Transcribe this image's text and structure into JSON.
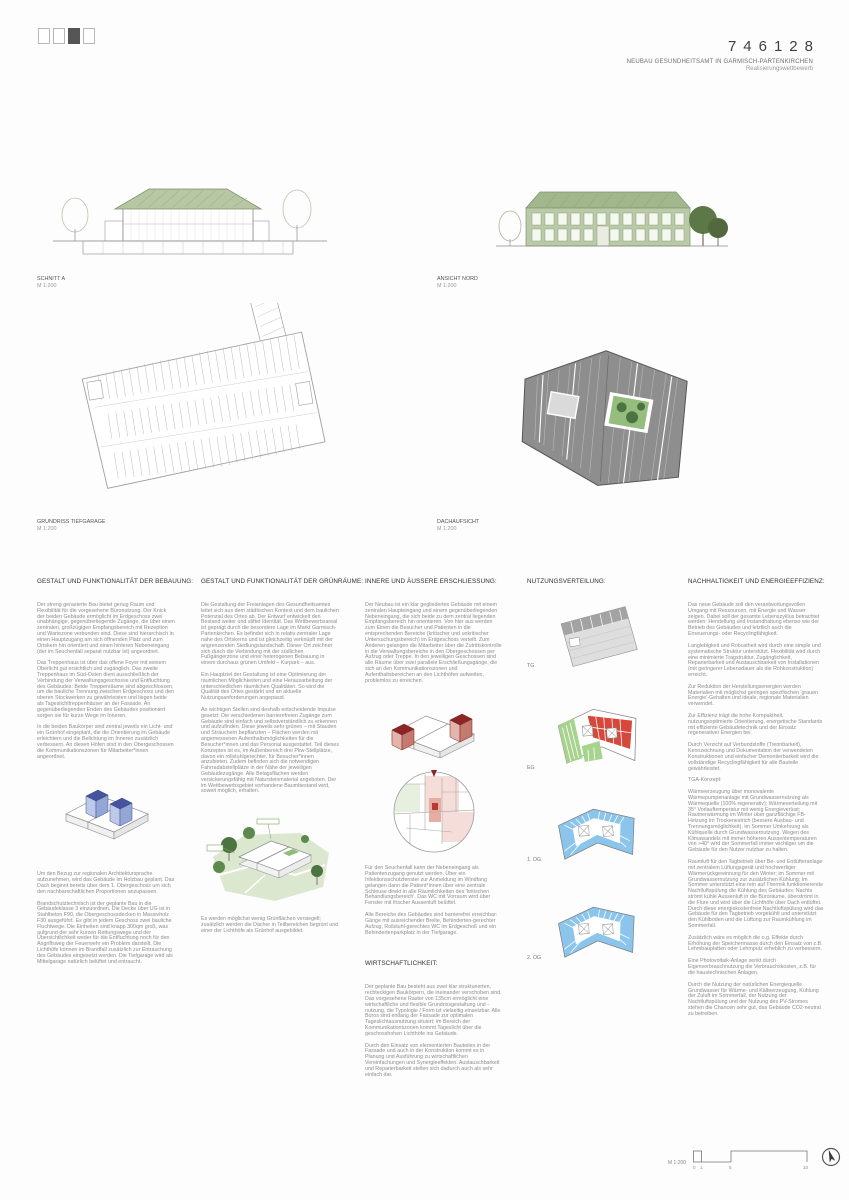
{
  "page_indicator": {
    "squares": [
      "empty",
      "empty",
      "filled",
      "empty"
    ]
  },
  "header": {
    "code": "746128",
    "title": "NEUBAU GESUNDHEITSAMT IN GARMISCH-PARTENKIRCHEN",
    "subtitle": "Realisierungswettbewerb"
  },
  "drawings": {
    "schnitt_a": {
      "label": "SCHNITT A",
      "scale": "M 1:200"
    },
    "ansicht_nord": {
      "label": "ANSICHT NORD",
      "scale": "M 1:200"
    },
    "tiefgarage": {
      "label": "GRUNDRISS TIEFGARAGE",
      "scale": "M 1:200"
    },
    "dachaufsicht": {
      "label": "DACHAUFSICHT",
      "scale": "M 1:200"
    }
  },
  "sections": {
    "bebauung": {
      "heading": "GESTALT UND FUNKTIONALITÄT DER BEBAUUNG:",
      "paras_before": [
        "Der streng gerasterte Bau bietet genug Raum und Flexibilität für die vorgesehene Büronutzung. Der Knick der beiden Gebäude ermöglicht im Erdgeschoss zwei unabhängige, gegenüberliegende Zugänge, die über einen zentralen, großzügigen Empfangsbereich mit Rezeption und Wartezone verbunden sind. Diese sind hierarchisch in einen Hauptzugang am sich öffnenden Platz und zum Ortskern hin orientiert und einen hinteren Nebeneingang (der im Seuchenfall separat nutzbar ist) angeordnet.",
        "Das Treppenhaus ist über das offene Foyer mit seinem Oberlicht gut ersichtlich und zugänglich. Das zweite Treppenhaus im Süd-Osten dient ausschließlich der Verbindung der Verwaltungsgeschosse und Entfluchtung des Gebäudes: Beide Treppenräume sind abgeschlossen, um die bauliche Trennung zwischen Erdgeschoss und den oberen Stockwerken zu gewährleisten und liegen beide als Tageslichttreppenhäuser an der Fassade. An gegenüberliegenden Enden des Gebäudes positioniert sorgen sie für kurze Wege im Inneren.",
        "In die beiden Baukörper sind zentral jeweils ein Licht- und ein Grünhof eingeplant, die die Orientierung im Gebäude erleichtern und die Belichtung im Inneren zusätzlich verbessern. An diesen Höfen sind in den Obergeschossen die Kommunikationszonen für Mitarbeiter*innen angeordnet."
      ],
      "paras_after": [
        "Um den Bezug zur regionalen Architektursprache aufzunehmen, wird das Gebäude im Holzbau geplant. Das Dach beginnt bereits über dem 1. Obergeschoss um sich den nachbarschaftlichen Proportionen anzupassen.",
        "Brandschutztechnisch ist der geplante Bau in die Gebäudeklasse 3 einzuordnen. Die Decke über UG ist in Stahlbeton F90, die Obergeschossdecken in Massivholz F30 ausgeführt. Es gibt in jedem Geschoss zwei bauliche Fluchtwege. Die Einheiten sind knapp 300qm groß, was aufgrund der sehr kurzen Rettungswege und der Übersichtlichkeit weder für die Entfluchtung noch für den Angriffsweg der Feuerwehr ein Problem darstellt. Die Lichthöfe können im Brandfall zusätzlich zur Entrauchung des Gebäudes eingesetzt werden. Die Tiefgarage wird als Mittelgarage natürlich belüftet und entraucht."
      ]
    },
    "gruenraeume": {
      "heading": "GESTALT UND FUNKTIONALITÄT DER GRÜNRÄUME:",
      "paras_before": [
        "Die Gestaltung der Freianlagen des Gesundheitsamtes leitet sich aus dem städtischen Kontext und dem baulichen Potenzial des Ortes ab. Der Entwurf entwickelt den Bestand weiter und stiftet Identität. Das Wettbewerbsareal ist geprägt durch die besondere Lage im Markt Garmisch-Partenkirchen. Es befindet sich in relativ zentraler Lage nahe des Ortskerns und ist gleichzeitig verknüpft mit der angrenzenden Siedlungslandschaft. Dieser Ort zeichnet sich durch die Verbindung mit der südlichen Fußgängerzone und einer heterogenen Bebauung in einem durchaus grünen Umfeld – Kurpark – aus.",
        "Ein Hauptziel der Gestaltung ist eine Optimierung der räumlichen Möglichkeiten und eine Herausarbeitung der unterschiedlichen räumlichen Qualitäten. So wird die Qualität des Ortes gestärkt und an aktuelle Nutzungsanforderungen angepasst.",
        "An wichtigen Stellen sind deshalb entscheidende Impulse gesetzt: Die verschiedenen barrierefreien Zugänge zum Gebäude sind einfach und selbstverständlich zu erkennen und aufzufinden. Diese jeweils sehr grünen – mit Stauden und Sträuchern bepflanzten – Flächen werden mit angemessenen Aufenthaltsmöglichkeiten für die Besucher*innen und das Personal ausgestattet. Teil dieses Konzeptes ist es, im Außenbereich drei Pkw-Stellplätze, davon ein rollstuhlgerechter, für Besucher*innen anzubieten. Zudem befinden sich die notwendigen Fahrradabstellplätze in der Nähe der jeweiligen Gebäudezugänge. Alle Belagsflächen werden versickerungsfähig mit Natursteinmaterial angeboten. Der im Wettbewerbsgebiet vorhandene Baumbestand wird, soweit möglich, erhalten."
      ],
      "paras_after": [
        "Es werden möglichst wenig Grünflächen versiegelt; zusätzlich werden die Dächer in Teilbereichen begrünt und einer der Lichthöfe als Grünhof ausgebildet."
      ]
    },
    "erschliessung": {
      "heading": "INNERE UND ÄUSSERE ERSCHLIESSUNG:",
      "paras_before": [
        "Der Neubau ist ein klar gegliedertes Gebäude mit einem zentralen Haupteingang und einem gegenüberliegenden Nebeneingang, die sich beide zu dem zentral liegenden Empfangsbereich hin orientieren. Von hier aus werden zum Einen die Besucher und Patienten in die entsprechenden Bereiche (kritischer und unkritischer Untersuchungsbereich) im Erdgeschoss verteilt. Zum Anderen gelangen die Mitarbeiter über die Zutrittskontrolle in die Verwaltungsbereiche in den Obergeschossen per Aufzug oder Treppe. In den jeweiligen Geschossen sind alle Räume über zwei parallele Erschließungsgänge, die sich an den Kommunikationszonen und Aufenthaltsbereichen an den Lichthöfen aufweiten, problemlos zu erreichen."
      ],
      "paras_after": [
        "Für den Seuchenfall kann der Nebeneingang als Patientenzugang genutzt werden. Über ein Infektionsschutzfenster zur Anmeldung im Windfang gelangen dann die Patient*innen über eine zentrale Schleuse direkt in alle Räumlichkeiten des 'kritischen Behandlungsbereich'. Das WC mit Vorraum wird über Fenster mit frischer Aussenluft belüftet.",
        "Alle Bereiche des Gebäudes sind barrierefrei erreichbar: Gänge mit ausreichender Breite, Behinderten-gerechter Aufzug, Rollstuhl-gerechtes WC im Erdgeschoß und ein Behindertenparkplatz in der Tiefgarage."
      ]
    },
    "wirtschaftlichkeit": {
      "heading": "WIRTSCHAFTLICHKEIT:",
      "paras": [
        "Der geplante Bau besteht aus zwei klar strukturierten, rechteckigen Baukörpern, die ineinander verschoben sind. Das vorgesehene Raster von 135cm ermöglicht eine wirtschaftliche und flexible Grundrissgestaltung und -nutzung, die Typologie / Form ist vielseitig einsetzbar. Alle Büros sind entlang der Fassade zur optimalen Tageslichtausnutzung situiert; im Bereich der Kommunikationszonen kommt Tageslicht über die geschosshohen Lichthöfe ins Gebäude.",
        "Durch den Einsatz von elementierten Bauteilen in der Fassade und auch in der Konstruktion kommt es in Planung und Ausführung zu wirtschaftlichen Vereinfachungen und Synergieeffekten. Austauschbarkeit und Reparierbarkeit stellen sich dadurch auch als sehr einfach dar."
      ]
    },
    "nutzung": {
      "heading": "NUTZUNGSVERTEILUNG:",
      "levels": [
        "TG",
        "EG",
        "1. OG",
        "2. OG"
      ]
    },
    "nachhaltigkeit": {
      "heading": "NACHHALTIGKEIT UND ENERGIEEFFIZIENZ:",
      "paras": [
        "Das neue Gebäude soll den verantwortungsvollen Umgang mit Ressourcen, mit Energie und Wasser zeigen. Dabei soll der gesamte Lebenszyklus betrachtet werden: Herstellung und Instandhaltung ebenso wie der Betrieb des Gebäudes und letztlich auch die Erneuerungs- oder Recyclingfähigkeit.",
        "Langlebigkeit und Robustheit wird durch eine simple und systematische Struktur unterstützt. Flexibilität wird durch eine minimierte Tragstruktur, Zugänglichkeit, Reparierbarkeit und Austauschbarkeit von Installationen (mit geringerer Lebensdauer als die Rohkonstruktion) erreicht.",
        "Zur Reduktion der Herstellungsenergien werden Materialien mit möglichst geringen spezifischen 'grauen Energie'-Gehalten und ideale, regionale Materialien verwendet.",
        "Zur Effizienz trägt die hohe Kompaktheit, nutzungsoptimierte Orientierung, energetische Standards mit effiziente Gebäudetechnik und der Einsatz regenerativer Energien bei.",
        "Durch Verzicht auf Verbundstoffe (Trennbarkeit), Kennzeichnung und Dokumentation der verwendeten Konstruktionen und einfacher Demontierbarkeit wird die vollständige Recyclingfähigkeit für alle Bauteile gewährleistet.",
        "TGA-Konzept:",
        "Wärmeerzeugung über monovalente Wärmepumpenanlage mit Grundwassernutzung als Wärmequelle (100% regenerativ); Wärmeverteilung mit 35° Vorlauftemperatur mit wenig Energieverlust; Raumerwärmung im Winter über ganzflächige FB-Heizung im Trockenestrich (bessere Ausbau- und Trennungsmöglichkeit), im Sommer Umkehrung als Kühlquelle durch Grundwassernutzung. Wegen des Klimawandels mit immer höheren Aussentemperaturen von >40° wird der Sommerfall immer wichtiger um die Gebäude für den Nutzer nutzbar zu halten.",
        "Raumluft für den Tagbetrieb über Be- und Entlüfteranlage mit zentralem Lüftungsgerät und hochwertiger Wärmerückgewinnung für den Winter; im Sommer mit Grundwassernutzung zur zusätzlichen Kühlung; Im Sommer unterstützt eine rein auf Thermik funktionierende Nachtluftspülung die Kühlung des Gebäudes: Nachts strömt kühle Aussenluft in die Büroräume, überströmt in die Flure und wird über die Lichthöfe über Dach entlüftet. Durch diese energiekostenfreie Nachtluftspülung wird das Gebäude für den Tagbetrieb vorgekühlt und unterstützt den Kühlboden und die Lüftung zur Raumkühlung im Sommerfall.",
        "Zusätzlich wäre es möglich die o.g. Effekte durch Erhöhung der Speichermasse durch den Einsatz von z.B. Lehmbauplatten oder Lehmputz erheblich zu verbessern.",
        "Eine Photovoltaik-Anlage senkt durch Eigenverbrauchnutzung die Verbrauchskosten, z.B. für die haustechnischen Anlagen.",
        "Durch die Nutzung der natürlichen Energiequelle Grundwasser für Wärme- und Kälteerzeugung, Kühlung der Zuluft im Sommerfall, der Nutzung der Nachtluftspülung und der Nutzung des PV-Stromes stehen die Chancen sehr gut, das Gebäude CO2-neutral zu betreiben."
      ]
    }
  },
  "scalebar": {
    "label": "M 1:200",
    "ticks": [
      "0",
      "1",
      "5",
      "10"
    ]
  },
  "colors": {
    "tree_green": "#4c7440",
    "facade_green": "#a9bd92",
    "room_blue": "#8cc5ec",
    "court_blue_dark": "#46549e",
    "room_red": "#d6483c",
    "core_red_dark": "#8c2626",
    "roof_gray": "#8e8e8e"
  }
}
